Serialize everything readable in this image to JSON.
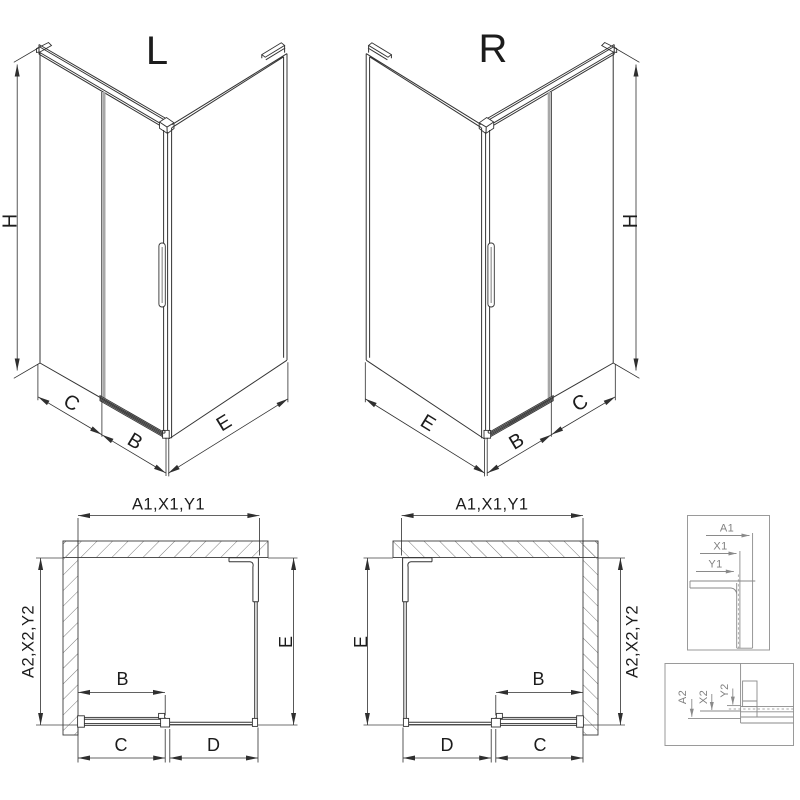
{
  "drawing": {
    "iso_left": {
      "title": "L",
      "dim_height": "H",
      "dim_c": "C",
      "dim_b": "B",
      "dim_e": "E"
    },
    "iso_right": {
      "title": "R",
      "dim_height": "H",
      "dim_e": "E",
      "dim_b": "B",
      "dim_c": "C"
    },
    "plan_left": {
      "dim_width": "A1,X1,Y1",
      "dim_depth": "A2,X2,Y2",
      "dim_e": "E",
      "dim_b": "B",
      "dim_c": "C",
      "dim_d": "D"
    },
    "plan_right": {
      "dim_width": "A1,X1,Y1",
      "dim_depth": "A2,X2,Y2",
      "dim_e": "E",
      "dim_b": "B",
      "dim_d": "D",
      "dim_c": "C"
    },
    "detail_top": {
      "dim_a1": "A1",
      "dim_x1": "X1",
      "dim_y1": "Y1"
    },
    "detail_bottom": {
      "dim_a2": "A2",
      "dim_x2": "X2",
      "dim_y2": "Y2"
    },
    "colors": {
      "ink": "#2f2f2f",
      "detail_gray": "#8a8a8a",
      "hatch_gray": "#7a7a7a",
      "door_gray": "#a8a8a8",
      "background": "#ffffff"
    }
  }
}
